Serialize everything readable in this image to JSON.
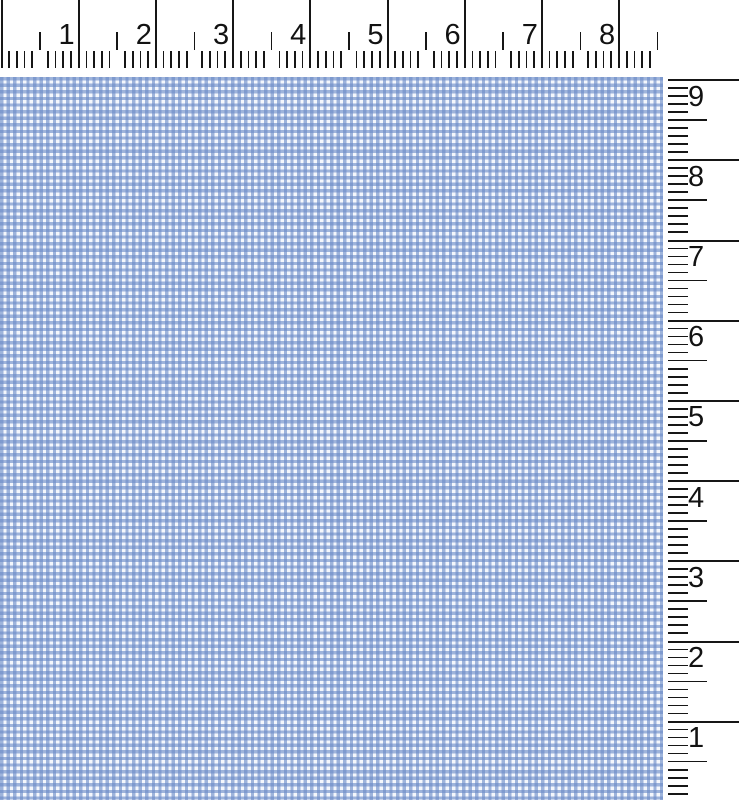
{
  "view": {
    "name": "fabric swatch with measurement rulers"
  },
  "horizontal_ruler": {
    "unit_labels": [
      "1",
      "2",
      "3",
      "4",
      "5",
      "6",
      "7",
      "8"
    ],
    "divisions_per_unit": 10
  },
  "vertical_ruler": {
    "unit_labels": [
      "9",
      "8",
      "7",
      "6",
      "5",
      "4",
      "3",
      "2",
      "1"
    ],
    "divisions_per_unit": 10
  },
  "rulers": {
    "tick_color": "#161616",
    "background": "#ffffff",
    "number_color": "#121212"
  },
  "swatch": {
    "pattern": "blue-white gingham micro-check",
    "colors": {
      "stripe": "rgba(106,138,199,0.62)",
      "base": "#f4f7fc",
      "check_dark_blue": "#7e9ace",
      "check_medium_blue": "#9eb3db",
      "check_white": "#f4f7fc"
    }
  }
}
